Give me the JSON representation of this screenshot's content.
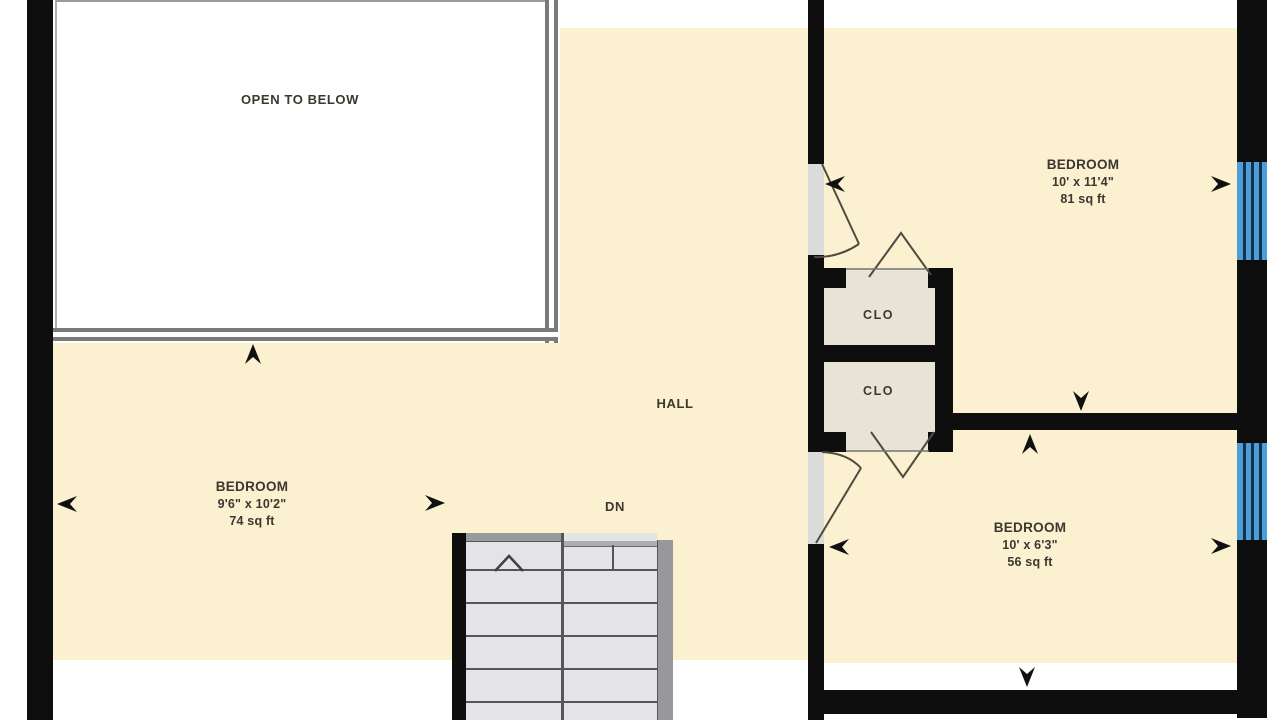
{
  "plan": {
    "title": "Second floor plan",
    "open_to_below_label": "OPEN TO BELOW",
    "hall_label": "HALL",
    "stairs_down_label": "DN",
    "closet_labels": [
      "CLO",
      "CLO"
    ],
    "bedrooms": [
      {
        "name": "BEDROOM",
        "dimensions": "9'6\" x 10'2\"",
        "area": "74 sq ft"
      },
      {
        "name": "BEDROOM",
        "dimensions": "10' x 11'4\"",
        "area": "81 sq ft"
      },
      {
        "name": "BEDROOM",
        "dimensions": "10' x 6'3\"",
        "area": "56 sq ft"
      }
    ],
    "colors": {
      "floor_fill": "#FBF0D0",
      "wall": "#0E0E0E",
      "window_blue": "#4C9ED8",
      "closet_fill": "#E9E2D7",
      "stairs_fill": "#E4E4E6",
      "railing_gray": "#7A7A7A",
      "text": "#3C372F"
    }
  }
}
